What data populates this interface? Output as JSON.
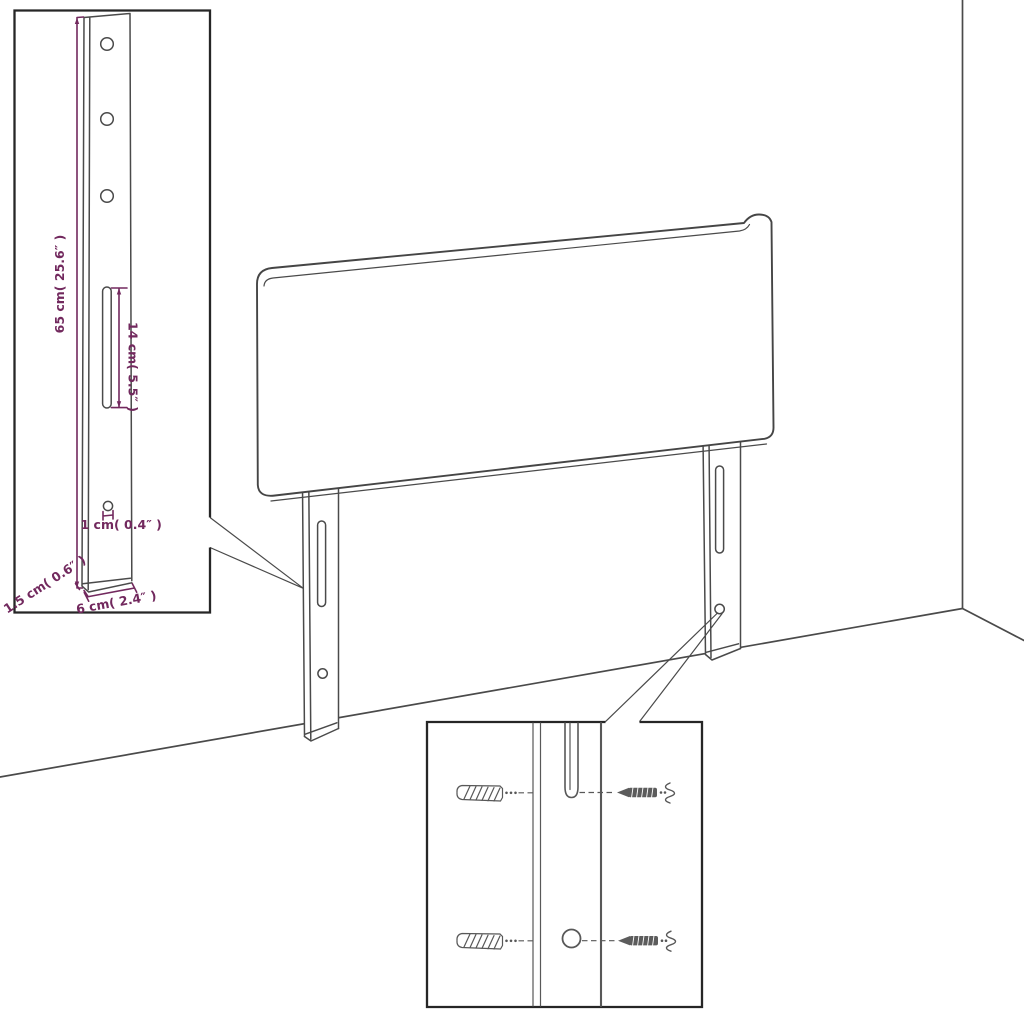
{
  "title": "Headboard with legs assembly dimension diagram",
  "colors": {
    "dimension": "#72295e",
    "outline": "#4a4a4a",
    "box_border": "#262626"
  },
  "insets": {
    "bracket_detail": {
      "dim_height_label": "65 cm( 25.6″ )",
      "dim_slot_label": "14 cm( 5.5″ )",
      "dim_hole_label": "1 cm( 0.4″ )",
      "dim_thickness_label": "1.5 cm( 0.6″ )",
      "dim_width_label": "6 cm( 2.4″ )"
    }
  }
}
